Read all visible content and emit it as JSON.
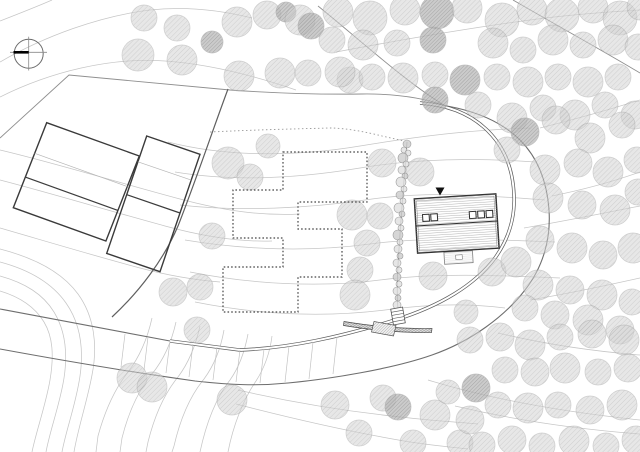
{
  "meta": {
    "title": "Architectural site plan with forest, loop driveway, main house, neighbour buildings and dotted footprint"
  },
  "palette": {
    "contour": "#c6c6c6",
    "boundary": "#8f8f8f",
    "boundary_dark": "#5f5f5f",
    "road": "#5a5a5a",
    "dotted": "#454545",
    "building": "#3a3a3a",
    "tree_fill": "#d4d4d4",
    "tree_hatch": "#a8a8a8",
    "tree_dark_fill": "#b8b8b8",
    "marker": "#111111",
    "paper": "#ffffff"
  },
  "north": {
    "cx": 28.7,
    "cy": 53.7,
    "r": 14.5,
    "h": [
      10,
      52.3,
      47,
      52.3
    ],
    "v": [
      28.7,
      36.7,
      28.7,
      70.5
    ],
    "bold": [
      13.5,
      52.3,
      28.7,
      52.3
    ]
  },
  "contours": [
    "M 0,21 C 18,14 36,7 52,0",
    "M 0,62 C 45,36 100,16 150,10 C 186,6 220,10 252,18",
    "M 0,97 C 50,72 110,57 165,61 C 210,64 255,76 296,90",
    "M 0,150 C 55,163 120,183 180,199 C 225,211 262,216 300,214",
    "M 0,180 C 50,193 110,211 165,226 C 205,237 240,242 272,241",
    "M 0,228 C 45,241 95,256 140,268 C 170,276 195,280 220,282",
    "M 336,52 C 400,40 470,28 530,20 C 566,15 606,12 640,10",
    "M 540,128 C 572,120 608,110 640,100",
    "M 552,196 C 582,190 612,182 640,172",
    "M 524,228 C 560,222 600,214 640,206",
    "M 530,300 C 566,294 604,286 640,278",
    "M 168,142 C 230,158 300,156 360,146 C 420,136 470,130 530,128",
    "M 175,172 C 235,182 300,178 360,168 C 420,158 480,158 535,162",
    "M 180,205 C 240,212 310,208 365,200 C 430,190 490,196 545,200",
    "M 185,240 C 245,250 310,252 370,244 C 430,236 500,240 555,242",
    "M 190,272 C 250,284 320,288 380,280 C 440,272 510,276 560,278",
    "M 195,302 C 255,314 320,318 385,310 C 445,302 480,305 505,308",
    "M 0,249 C 35,258 62,272 78,294 C 94,316 98,345 92,375 C 87,402 78,428 74,452",
    "M 0,262 C 30,270 52,283 66,303 C 80,323 84,348 80,376 C 76,404 66,430 62,452",
    "M 0,276 C 25,283 43,294 54,312 C 65,330 68,352 64,378 C 60,404 50,430 46,452",
    "M 0,291 C 20,297 35,307 44,322 C 53,337 54,356 50,380 C 46,404 36,432 32,452",
    "M 152,318 C 148,336 141,355 128,372 C 114,390 104,414 98,436 L 96,452",
    "M 176,322 C 172,340 165,358 152,374 C 138,391 128,414 122,438 L 120,452",
    "M 200,326 C 196,344 190,361 178,377 C 164,394 154,418 148,442 L 146,452",
    "M 224,330 C 221,347 215,364 204,379 C 190,396 180,420 174,446 L 172,452",
    "M 248,334 C 245,350 240,366 230,380 C 216,398 206,424 200,452",
    "M 272,336 C 270,352 265,367 256,381 C 243,400 233,426 228,452",
    "M 238,390 C 290,402 350,412 410,418 C 436,421 458,422 478,424",
    "M 236,404 C 290,418 350,432 410,442 C 430,445 450,447 468,449",
    "M 498,333 C 540,343 590,351 640,355",
    "M 428,380 C 480,396 545,410 640,420",
    "M 455,406 C 510,419 575,429 640,434"
  ],
  "boundaries": {
    "light": [
      "M 0,138 L 69,75 L 230,90",
      "M 230,90 C 280,93.5 325,94.5 362,94 C 398,93.5 424,98 447,106",
      "M 318,6 C 360,40 408,84 447,107",
      "M 513,0 C 556,25 600,49 640,73"
    ],
    "dark": [
      "M 228,89 C 212,132 196,180 178,226 C 164,259 140,291 112,317"
    ]
  },
  "road": {
    "approach": "M 0,309 C 60,320 120,332 170,341",
    "outer": "M 0,349 C 60,360 130,372 195,381 C 230,385 258,386 288,383 C 330,379 392,369 432,355 C 472,341 505,316 525,290 C 543,267 551,239 549,210 C 547,182 538,158 520,140 C 504,124 480,112 447,106",
    "loop": "M 170,341 C 195,344 218,347 240,350 C 290,348 340,337 395,320 C 440,306 475,285 495,258 C 510,237 515,215 514,195 C 513,170 505,148 488,131 C 472,115 450,105 420,103",
    "ticks": [
      [
        125,
        334,
        121,
        367
      ],
      [
        148,
        337,
        144,
        370
      ],
      [
        170,
        341,
        166,
        373
      ],
      [
        193,
        344,
        189,
        377
      ],
      [
        217,
        347,
        213,
        380
      ],
      [
        240,
        350,
        236,
        382
      ],
      [
        264,
        349,
        260,
        383
      ],
      [
        289,
        346,
        285,
        382
      ],
      [
        313,
        342,
        309,
        379
      ],
      [
        337,
        337,
        333,
        374
      ]
    ]
  },
  "dashed_path": "M 210,132 C 250,130 290,129 330,128 C 346,128 366,132 382,136 L 404,141",
  "footprint_dotted": "283,152 367,152 367,202 298,202 298,229 342,229 342,277 298,277 298,312 223,312 223,267 283,267 283,238 233,238 233,190 283,190",
  "buildings": [
    {
      "points": "46.7,122.7 139.3,156 105.9,241 13.3,207.7",
      "lines": [
        {
          "x1": 34.7,
          "y1": 153.3,
          "x2": 127.3,
          "y2": 186.6,
          "w": 0.7,
          "c": "#b5b5b5"
        },
        {
          "x1": 25.3,
          "y1": 177.1,
          "x2": 117.9,
          "y2": 210.4,
          "w": 1.2,
          "c": "#3c3c3c"
        }
      ]
    },
    {
      "points": "146.7,136 200,154.3 160,271.7 106.7,253.4",
      "lines": [
        {
          "x1": 137.9,
          "y1": 161.8,
          "x2": 191.2,
          "y2": 180.1,
          "w": 0.7,
          "c": "#b5b5b5"
        },
        {
          "x1": 126.7,
          "y1": 194.7,
          "x2": 180,
          "y2": 213,
          "w": 1.2,
          "c": "#3c3c3c"
        }
      ]
    }
  ],
  "house": {
    "cx": 456.7,
    "cy": 223.5,
    "rot": -3.5,
    "w": 81.6,
    "h": 54.2,
    "sky_w": 6.6,
    "sky_h": 6.9,
    "skylights": [
      {
        "x": -33.6,
        "y": -11
      },
      {
        "x": -25.4,
        "y": -11
      },
      {
        "x": 13.2,
        "y": -11
      },
      {
        "x": 21.6,
        "y": -11
      },
      {
        "x": 30,
        "y": -11
      }
    ],
    "deck": {
      "x": -14.5,
      "y": 28,
      "w": 28.5,
      "h": 12,
      "inner": {
        "x": -3,
        "y": 31.5,
        "w": 6.5,
        "h": 4.5
      }
    },
    "marker": "435.5,187.5 444.5,187.5 440,195.5"
  },
  "hedge": {
    "path": "M 407,142 C 404,180 400,230 398,265 C 397,285 397,298 398,310",
    "shrubs": [
      [
        407,
        144,
        4
      ],
      [
        404,
        150,
        3
      ],
      [
        408,
        153,
        3
      ],
      [
        403,
        158,
        5
      ],
      [
        406,
        164,
        3
      ],
      [
        402,
        170,
        4
      ],
      [
        405,
        176,
        3
      ],
      [
        401,
        182,
        5
      ],
      [
        404,
        189,
        3
      ],
      [
        400,
        195,
        4
      ],
      [
        403,
        201,
        3
      ],
      [
        399,
        208,
        5
      ],
      [
        402,
        214,
        3
      ],
      [
        399,
        221,
        4
      ],
      [
        401,
        228,
        3
      ],
      [
        398,
        235,
        5
      ],
      [
        400,
        242,
        3
      ],
      [
        398,
        249,
        4
      ],
      [
        400,
        256,
        3
      ],
      [
        397,
        263,
        4
      ],
      [
        399,
        270,
        3
      ],
      [
        397,
        277,
        4
      ],
      [
        399,
        284,
        3
      ],
      [
        397,
        291,
        4
      ],
      [
        398,
        298,
        3
      ],
      [
        397,
        305,
        4
      ]
    ]
  },
  "steps": {
    "cx": 398,
    "cy": 316,
    "rot": -10,
    "w": 12,
    "h": 16,
    "rungs": [
      -4.8,
      -1.6,
      1.6,
      4.8
    ]
  },
  "ramp": {
    "points": "374,321.5 396,325.5 393.5,336 371.5,332"
  },
  "wall": {
    "path": "M 344,321.5 C 374,326.5 404,329 432,328.5 L 431.5,332.5 C 404,333 374,330.5 343.5,325.5 Z"
  },
  "trees": [
    [
      144,
      18,
      13,
      0
    ],
    [
      177,
      28,
      13,
      0
    ],
    [
      212,
      42,
      11,
      1
    ],
    [
      237,
      22,
      15,
      0
    ],
    [
      267,
      15,
      14,
      0
    ],
    [
      286,
      12,
      10,
      1
    ],
    [
      300,
      20,
      15,
      0
    ],
    [
      311,
      26,
      13,
      1
    ],
    [
      138,
      55,
      16,
      0
    ],
    [
      182,
      60,
      15,
      0
    ],
    [
      239,
      76,
      15,
      0
    ],
    [
      280,
      73,
      15,
      0
    ],
    [
      308,
      73,
      13,
      0
    ],
    [
      350,
      80,
      13,
      0
    ],
    [
      338,
      12,
      15,
      0
    ],
    [
      370,
      18,
      17,
      0
    ],
    [
      405,
      10,
      15,
      0
    ],
    [
      437,
      12,
      17,
      1
    ],
    [
      467,
      8,
      15,
      0
    ],
    [
      502,
      20,
      17,
      0
    ],
    [
      532,
      10,
      15,
      0
    ],
    [
      562,
      15,
      17,
      0
    ],
    [
      593,
      8,
      15,
      0
    ],
    [
      620,
      18,
      17,
      0
    ],
    [
      640,
      7,
      13,
      0
    ],
    [
      332,
      40,
      13,
      0
    ],
    [
      363,
      45,
      15,
      0
    ],
    [
      397,
      43,
      13,
      0
    ],
    [
      433,
      40,
      13,
      1
    ],
    [
      493,
      43,
      15,
      0
    ],
    [
      523,
      50,
      13,
      0
    ],
    [
      553,
      40,
      15,
      0
    ],
    [
      583,
      45,
      13,
      0
    ],
    [
      613,
      40,
      15,
      0
    ],
    [
      638,
      47,
      13,
      0
    ],
    [
      340,
      72,
      15,
      0
    ],
    [
      372,
      77,
      13,
      0
    ],
    [
      403,
      78,
      15,
      0
    ],
    [
      435,
      75,
      13,
      0
    ],
    [
      465,
      80,
      15,
      1
    ],
    [
      497,
      77,
      13,
      0
    ],
    [
      528,
      82,
      15,
      0
    ],
    [
      558,
      77,
      13,
      0
    ],
    [
      588,
      82,
      15,
      0
    ],
    [
      618,
      77,
      13,
      0
    ],
    [
      435,
      100,
      13,
      1
    ],
    [
      478,
      105,
      13,
      0
    ],
    [
      512,
      118,
      15,
      0
    ],
    [
      543,
      108,
      13,
      0
    ],
    [
      575,
      115,
      15,
      0
    ],
    [
      605,
      105,
      13,
      0
    ],
    [
      635,
      115,
      14,
      0
    ],
    [
      525,
      132,
      14,
      1
    ],
    [
      556,
      120,
      14,
      0
    ],
    [
      590,
      138,
      15,
      0
    ],
    [
      622,
      125,
      13,
      0
    ],
    [
      507,
      150,
      13,
      0
    ],
    [
      545,
      170,
      15,
      0
    ],
    [
      578,
      163,
      14,
      0
    ],
    [
      608,
      172,
      15,
      0
    ],
    [
      637,
      160,
      13,
      0
    ],
    [
      548,
      198,
      15,
      0
    ],
    [
      582,
      205,
      14,
      0
    ],
    [
      615,
      210,
      15,
      0
    ],
    [
      638,
      192,
      13,
      0
    ],
    [
      540,
      240,
      14,
      0
    ],
    [
      572,
      248,
      15,
      0
    ],
    [
      603,
      255,
      14,
      0
    ],
    [
      633,
      248,
      15,
      0
    ],
    [
      538,
      285,
      15,
      0
    ],
    [
      570,
      290,
      14,
      0
    ],
    [
      602,
      295,
      15,
      0
    ],
    [
      632,
      302,
      13,
      0
    ],
    [
      525,
      308,
      13,
      0
    ],
    [
      555,
      315,
      14,
      0
    ],
    [
      588,
      320,
      15,
      0
    ],
    [
      620,
      330,
      14,
      0
    ],
    [
      228,
      163,
      16,
      0
    ],
    [
      250,
      177,
      13,
      0
    ],
    [
      268,
      146,
      12,
      0
    ],
    [
      212,
      236,
      13,
      0
    ],
    [
      173,
      292,
      14,
      0
    ],
    [
      200,
      287,
      13,
      0
    ],
    [
      352,
      215,
      15,
      0
    ],
    [
      380,
      216,
      13,
      0
    ],
    [
      367,
      243,
      13,
      0
    ],
    [
      360,
      270,
      13,
      0
    ],
    [
      355,
      295,
      15,
      0
    ],
    [
      382,
      163,
      14,
      0
    ],
    [
      420,
      172,
      14,
      0
    ],
    [
      433,
      276,
      14,
      0
    ],
    [
      492,
      272,
      14,
      0
    ],
    [
      516,
      262,
      15,
      0
    ],
    [
      466,
      312,
      12,
      0
    ],
    [
      197,
      330,
      13,
      0
    ],
    [
      132,
      378,
      15,
      0
    ],
    [
      152,
      387,
      15,
      0
    ],
    [
      232,
      400,
      15,
      0
    ],
    [
      335,
      405,
      14,
      0
    ],
    [
      359,
      433,
      13,
      0
    ],
    [
      383,
      398,
      13,
      0
    ],
    [
      398,
      407,
      13,
      1
    ],
    [
      413,
      443,
      13,
      0
    ],
    [
      435,
      415,
      15,
      0
    ],
    [
      448,
      392,
      12,
      0
    ],
    [
      460,
      443,
      13,
      0
    ],
    [
      470,
      340,
      13,
      0
    ],
    [
      500,
      337,
      14,
      0
    ],
    [
      530,
      345,
      15,
      0
    ],
    [
      560,
      337,
      13,
      0
    ],
    [
      592,
      334,
      14,
      0
    ],
    [
      624,
      340,
      15,
      0
    ],
    [
      476,
      388,
      14,
      1
    ],
    [
      505,
      370,
      13,
      0
    ],
    [
      535,
      372,
      14,
      0
    ],
    [
      565,
      368,
      15,
      0
    ],
    [
      598,
      372,
      13,
      0
    ],
    [
      628,
      368,
      14,
      0
    ],
    [
      470,
      420,
      14,
      0
    ],
    [
      498,
      405,
      13,
      0
    ],
    [
      528,
      408,
      15,
      0
    ],
    [
      558,
      405,
      13,
      0
    ],
    [
      590,
      410,
      14,
      0
    ],
    [
      622,
      405,
      15,
      0
    ],
    [
      482,
      445,
      13,
      0
    ],
    [
      512,
      440,
      14,
      0
    ],
    [
      542,
      446,
      13,
      0
    ],
    [
      574,
      441,
      15,
      0
    ],
    [
      606,
      446,
      13,
      0
    ],
    [
      636,
      440,
      14,
      0
    ]
  ]
}
